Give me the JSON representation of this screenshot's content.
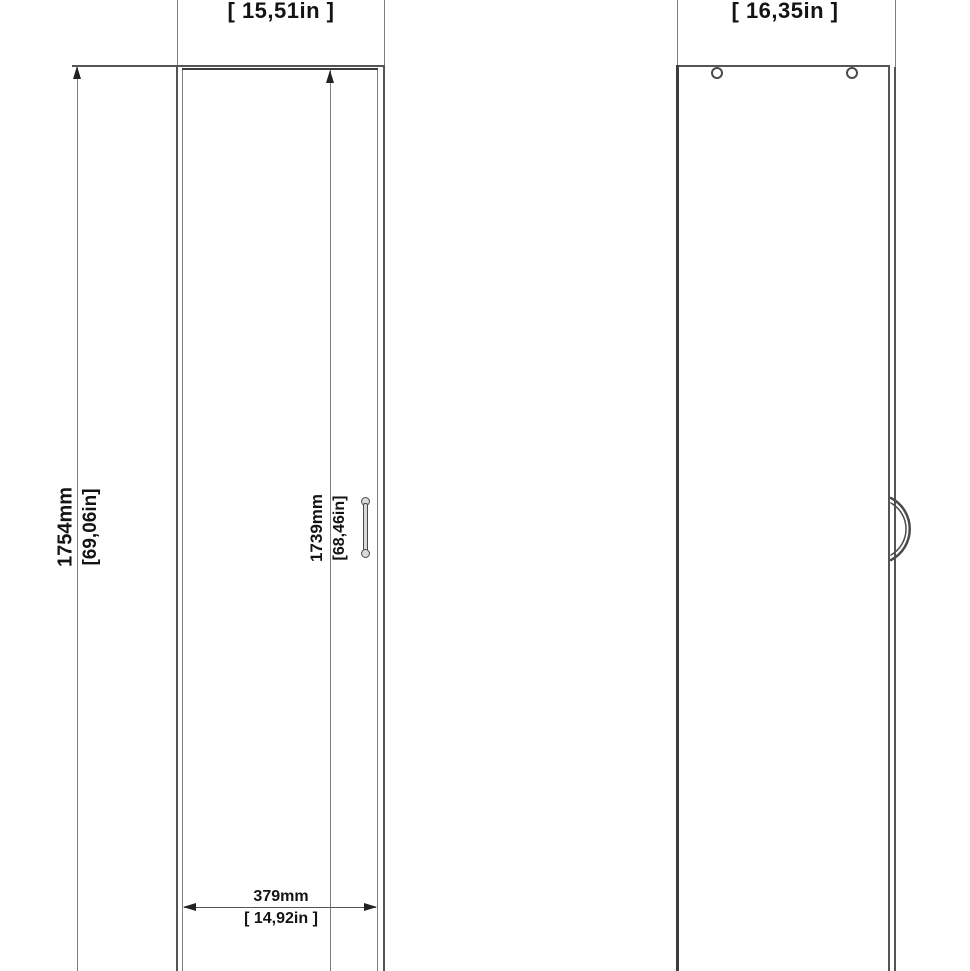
{
  "drawing": {
    "front_view": {
      "width_label": "[ 15,51in ]",
      "height_mm": "1754mm",
      "height_in": "[69,06in]",
      "door_height_mm": "1739mm",
      "door_height_in": "[68,46in]",
      "door_width_mm": "379mm",
      "door_width_in": "[ 14,92in ]"
    },
    "side_view": {
      "depth_label": "[ 16,35in ]"
    },
    "colors": {
      "line": "#4a4a4a",
      "dim_line": "#7e7e7e",
      "text": "#141414",
      "background": "#ffffff"
    }
  }
}
